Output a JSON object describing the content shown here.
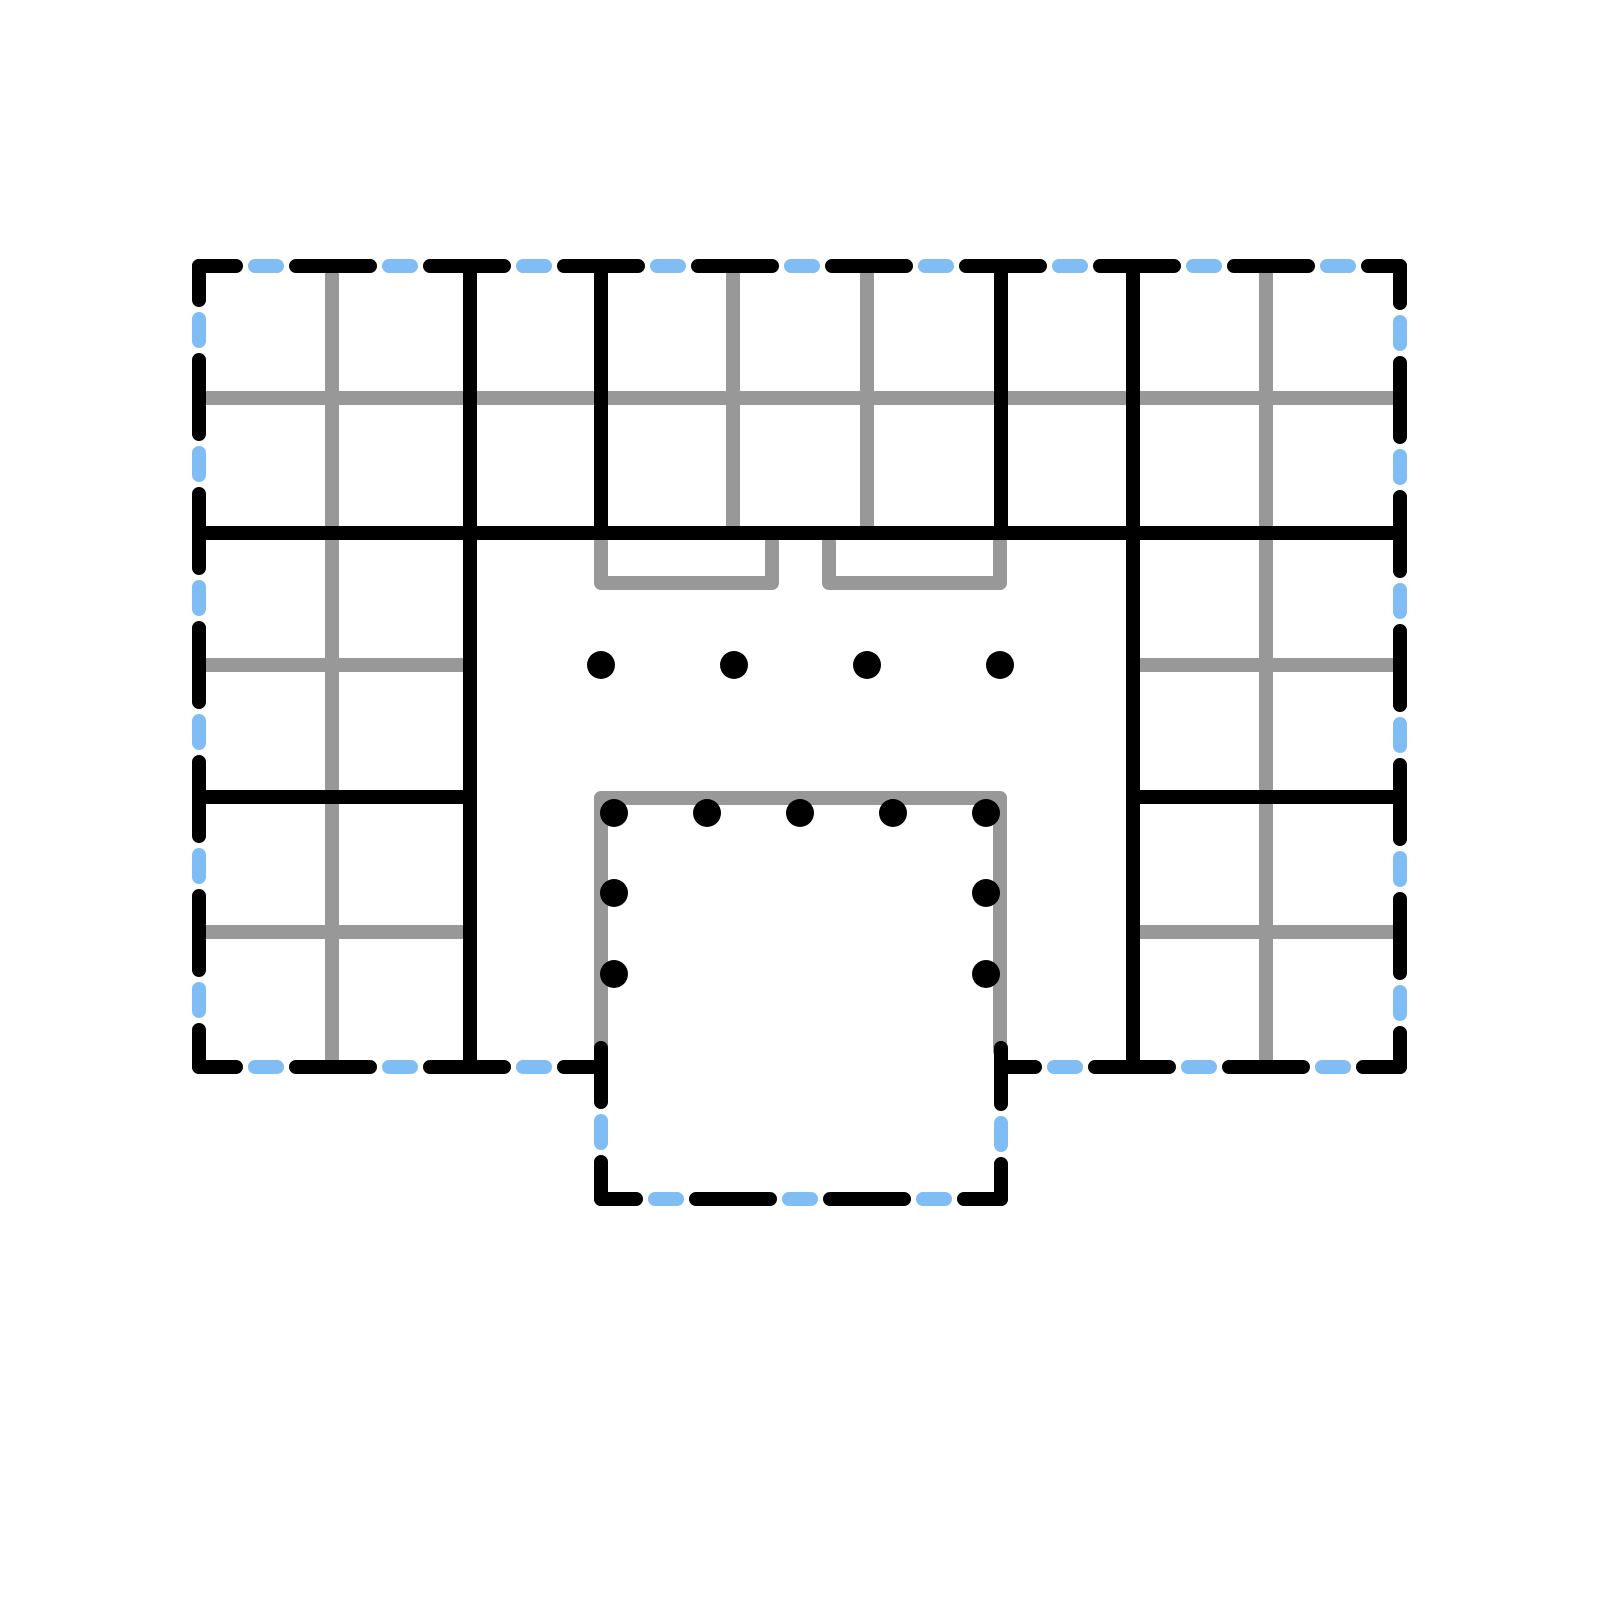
{
  "canvas": {
    "width": 1600,
    "height": 1600,
    "background": "#ffffff"
  },
  "palette": {
    "wall_black": "#000000",
    "partition_gray": "#989898",
    "accent_blue": "#80BDF4"
  },
  "stroke": {
    "wall_width": 14,
    "partition_width": 14,
    "dot_radius": 14,
    "black_dash": {
      "array": "74 60",
      "offset": 37
    },
    "blue_dash": {
      "array": "22 112",
      "offset": 78
    }
  },
  "exterior_boundary": {
    "segments": [
      {
        "name": "top-edge",
        "x1": 199,
        "y1": 266,
        "x2": 1400,
        "y2": 266
      },
      {
        "name": "right-edge",
        "x1": 1400,
        "y1": 266,
        "x2": 1400,
        "y2": 1067
      },
      {
        "name": "bottom-right-edge",
        "x1": 1400,
        "y1": 1067,
        "x2": 1001,
        "y2": 1067
      },
      {
        "name": "protrusion-right-edge",
        "x1": 1001,
        "y1": 1067,
        "x2": 1001,
        "y2": 1199
      },
      {
        "name": "protrusion-bottom-edge",
        "x1": 1001,
        "y1": 1199,
        "x2": 601,
        "y2": 1199
      },
      {
        "name": "protrusion-left-edge",
        "x1": 601,
        "y1": 1199,
        "x2": 601,
        "y2": 1067
      },
      {
        "name": "bottom-left-edge",
        "x1": 601,
        "y1": 1067,
        "x2": 199,
        "y2": 1067
      },
      {
        "name": "left-edge",
        "x1": 199,
        "y1": 1067,
        "x2": 199,
        "y2": 266
      }
    ]
  },
  "interior_walls": {
    "segments": [
      {
        "name": "middle-horizontal-wall",
        "x1": 199,
        "y1": 533,
        "x2": 1400,
        "y2": 533
      },
      {
        "name": "left-hall-wall",
        "x1": 470,
        "y1": 266,
        "x2": 470,
        "y2": 1067
      },
      {
        "name": "right-hall-wall",
        "x1": 1133,
        "y1": 266,
        "x2": 1133,
        "y2": 1067
      },
      {
        "name": "top-band-wall-2",
        "x1": 601,
        "y1": 266,
        "x2": 601,
        "y2": 533
      },
      {
        "name": "top-band-wall-3",
        "x1": 1001,
        "y1": 266,
        "x2": 1001,
        "y2": 533
      },
      {
        "name": "left-rooms-divider-wall",
        "x1": 199,
        "y1": 797,
        "x2": 470,
        "y2": 797
      },
      {
        "name": "right-rooms-divider-wall",
        "x1": 1133,
        "y1": 797,
        "x2": 1400,
        "y2": 797
      },
      {
        "name": "protrusion-left-junction",
        "x1": 601,
        "y1": 1048,
        "x2": 601,
        "y2": 1066
      },
      {
        "name": "protrusion-right-junction",
        "x1": 1001,
        "y1": 1048,
        "x2": 1001,
        "y2": 1066
      }
    ]
  },
  "partition_grid": {
    "lines": [
      {
        "name": "top-band-horizontal",
        "x1": 206,
        "y1": 398,
        "x2": 1393,
        "y2": 398
      },
      {
        "name": "top-left-room-vertical",
        "x1": 332,
        "y1": 274,
        "x2": 332,
        "y2": 525
      },
      {
        "name": "top-middle-room-vertical-1",
        "x1": 733,
        "y1": 274,
        "x2": 733,
        "y2": 525
      },
      {
        "name": "top-middle-room-vertical-2",
        "x1": 867,
        "y1": 274,
        "x2": 867,
        "y2": 525
      },
      {
        "name": "top-right-room-vertical",
        "x1": 1266,
        "y1": 274,
        "x2": 1266,
        "y2": 525
      },
      {
        "name": "mid-left-room-horizontal",
        "x1": 206,
        "y1": 665,
        "x2": 463,
        "y2": 665
      },
      {
        "name": "mid-left-room-vertical",
        "x1": 332,
        "y1": 541,
        "x2": 332,
        "y2": 789
      },
      {
        "name": "mid-right-room-horizontal",
        "x1": 1140,
        "y1": 665,
        "x2": 1393,
        "y2": 665
      },
      {
        "name": "mid-right-room-vertical",
        "x1": 1266,
        "y1": 541,
        "x2": 1266,
        "y2": 789
      },
      {
        "name": "lower-left-room-horizontal",
        "x1": 206,
        "y1": 932,
        "x2": 463,
        "y2": 932
      },
      {
        "name": "lower-left-room-vertical",
        "x1": 332,
        "y1": 805,
        "x2": 332,
        "y2": 1059
      },
      {
        "name": "lower-right-room-horizontal",
        "x1": 1140,
        "y1": 932,
        "x2": 1393,
        "y2": 932
      },
      {
        "name": "lower-right-room-vertical",
        "x1": 1266,
        "y1": 805,
        "x2": 1266,
        "y2": 1059
      }
    ],
    "paths": [
      {
        "name": "door-recess-left",
        "d": "M 601 542 L 601 583 L 772 583 L 772 542"
      },
      {
        "name": "door-recess-right",
        "d": "M 829 542 L 829 583 L 1000 583 L 1000 542"
      },
      {
        "name": "inner-room-outline",
        "d": "M 601 1051 L 601 798 L 1000 798 L 1000 1051"
      }
    ]
  },
  "column_dots": {
    "points": [
      {
        "x": 601,
        "y": 665
      },
      {
        "x": 734,
        "y": 665
      },
      {
        "x": 867,
        "y": 665
      },
      {
        "x": 1000,
        "y": 665
      },
      {
        "x": 614,
        "y": 813
      },
      {
        "x": 707,
        "y": 813
      },
      {
        "x": 800,
        "y": 813
      },
      {
        "x": 893,
        "y": 813
      },
      {
        "x": 986,
        "y": 813
      },
      {
        "x": 614,
        "y": 893
      },
      {
        "x": 614,
        "y": 974
      },
      {
        "x": 986,
        "y": 893
      },
      {
        "x": 986,
        "y": 974
      }
    ]
  }
}
